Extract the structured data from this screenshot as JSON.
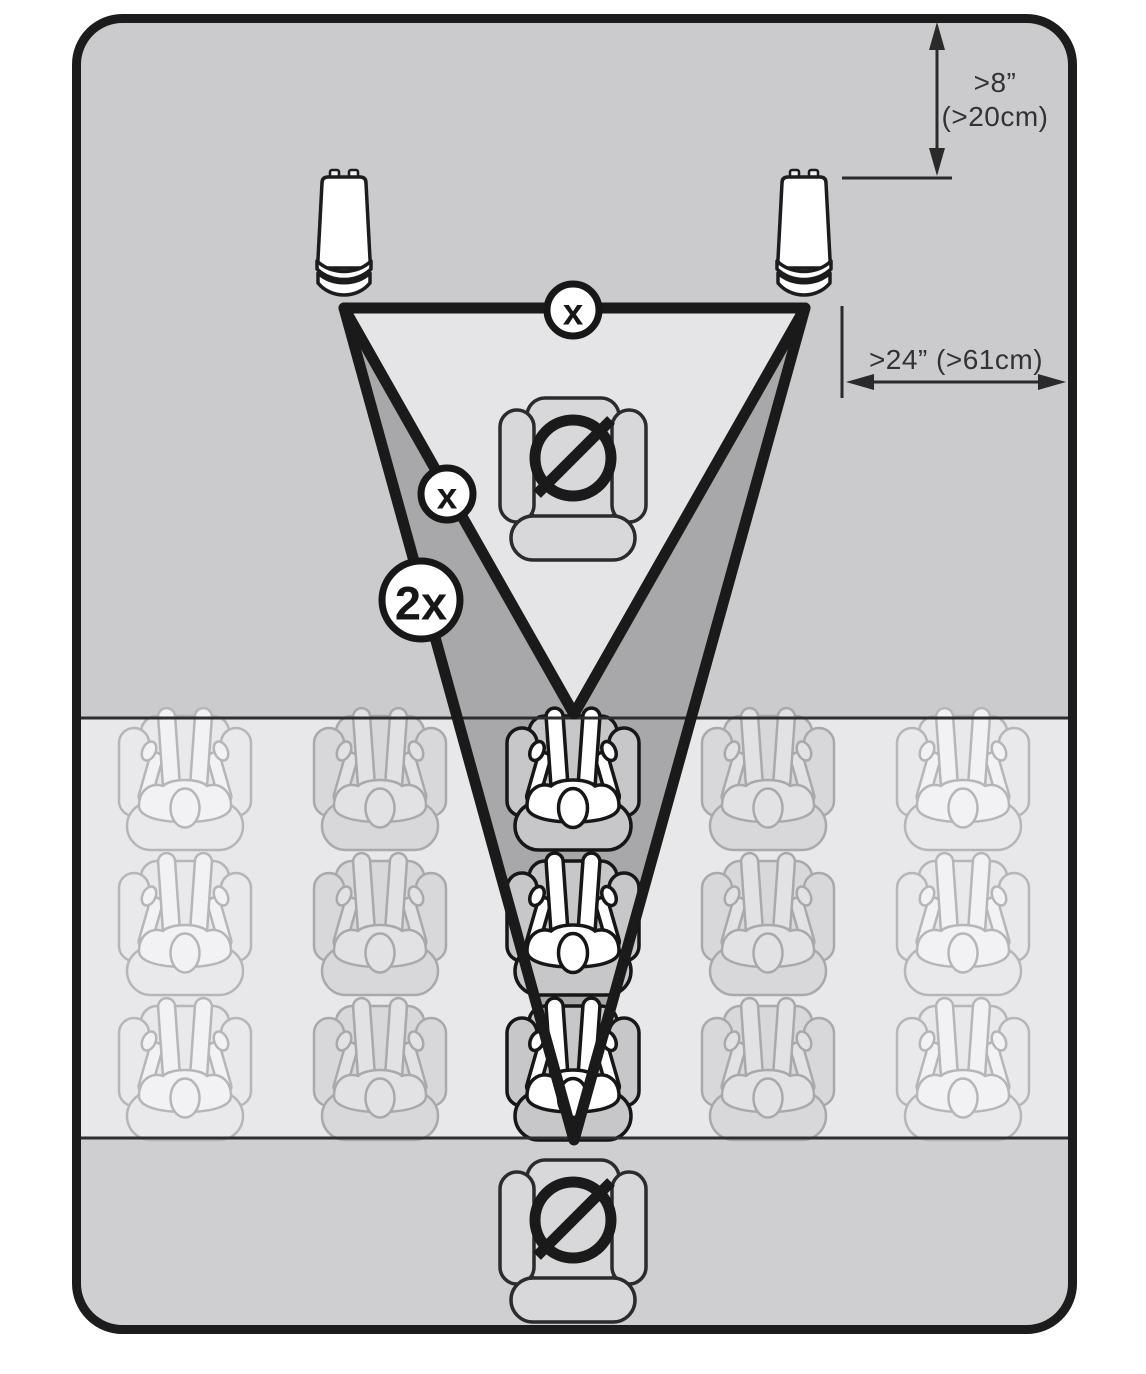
{
  "annotations": {
    "front_wall_distance": {
      "line1": ">8”",
      "line2": "(>20cm)"
    },
    "side_wall_distance": ">24” (>61cm)"
  },
  "badges": {
    "speaker_spacing": "x",
    "listening_distance": "x",
    "rear_listening_distance": "2x"
  },
  "seating": {
    "rows": 3,
    "columns": 5,
    "highlighted_column": 3,
    "prohibited_positions": [
      "front-center",
      "rear-center"
    ]
  },
  "speakers": {
    "count": 2
  },
  "colors": {
    "room_outline": "#1c1c1c",
    "zone_front": "#cbcbcd",
    "zone_seating": "#e8e8ea",
    "zone_rear": "#cfcfd1",
    "coverage_inner": "#e5e5e7",
    "coverage_outer": "#a8a8aa",
    "highlight_person": "#ffffff",
    "ink": "#1a1a1a"
  }
}
